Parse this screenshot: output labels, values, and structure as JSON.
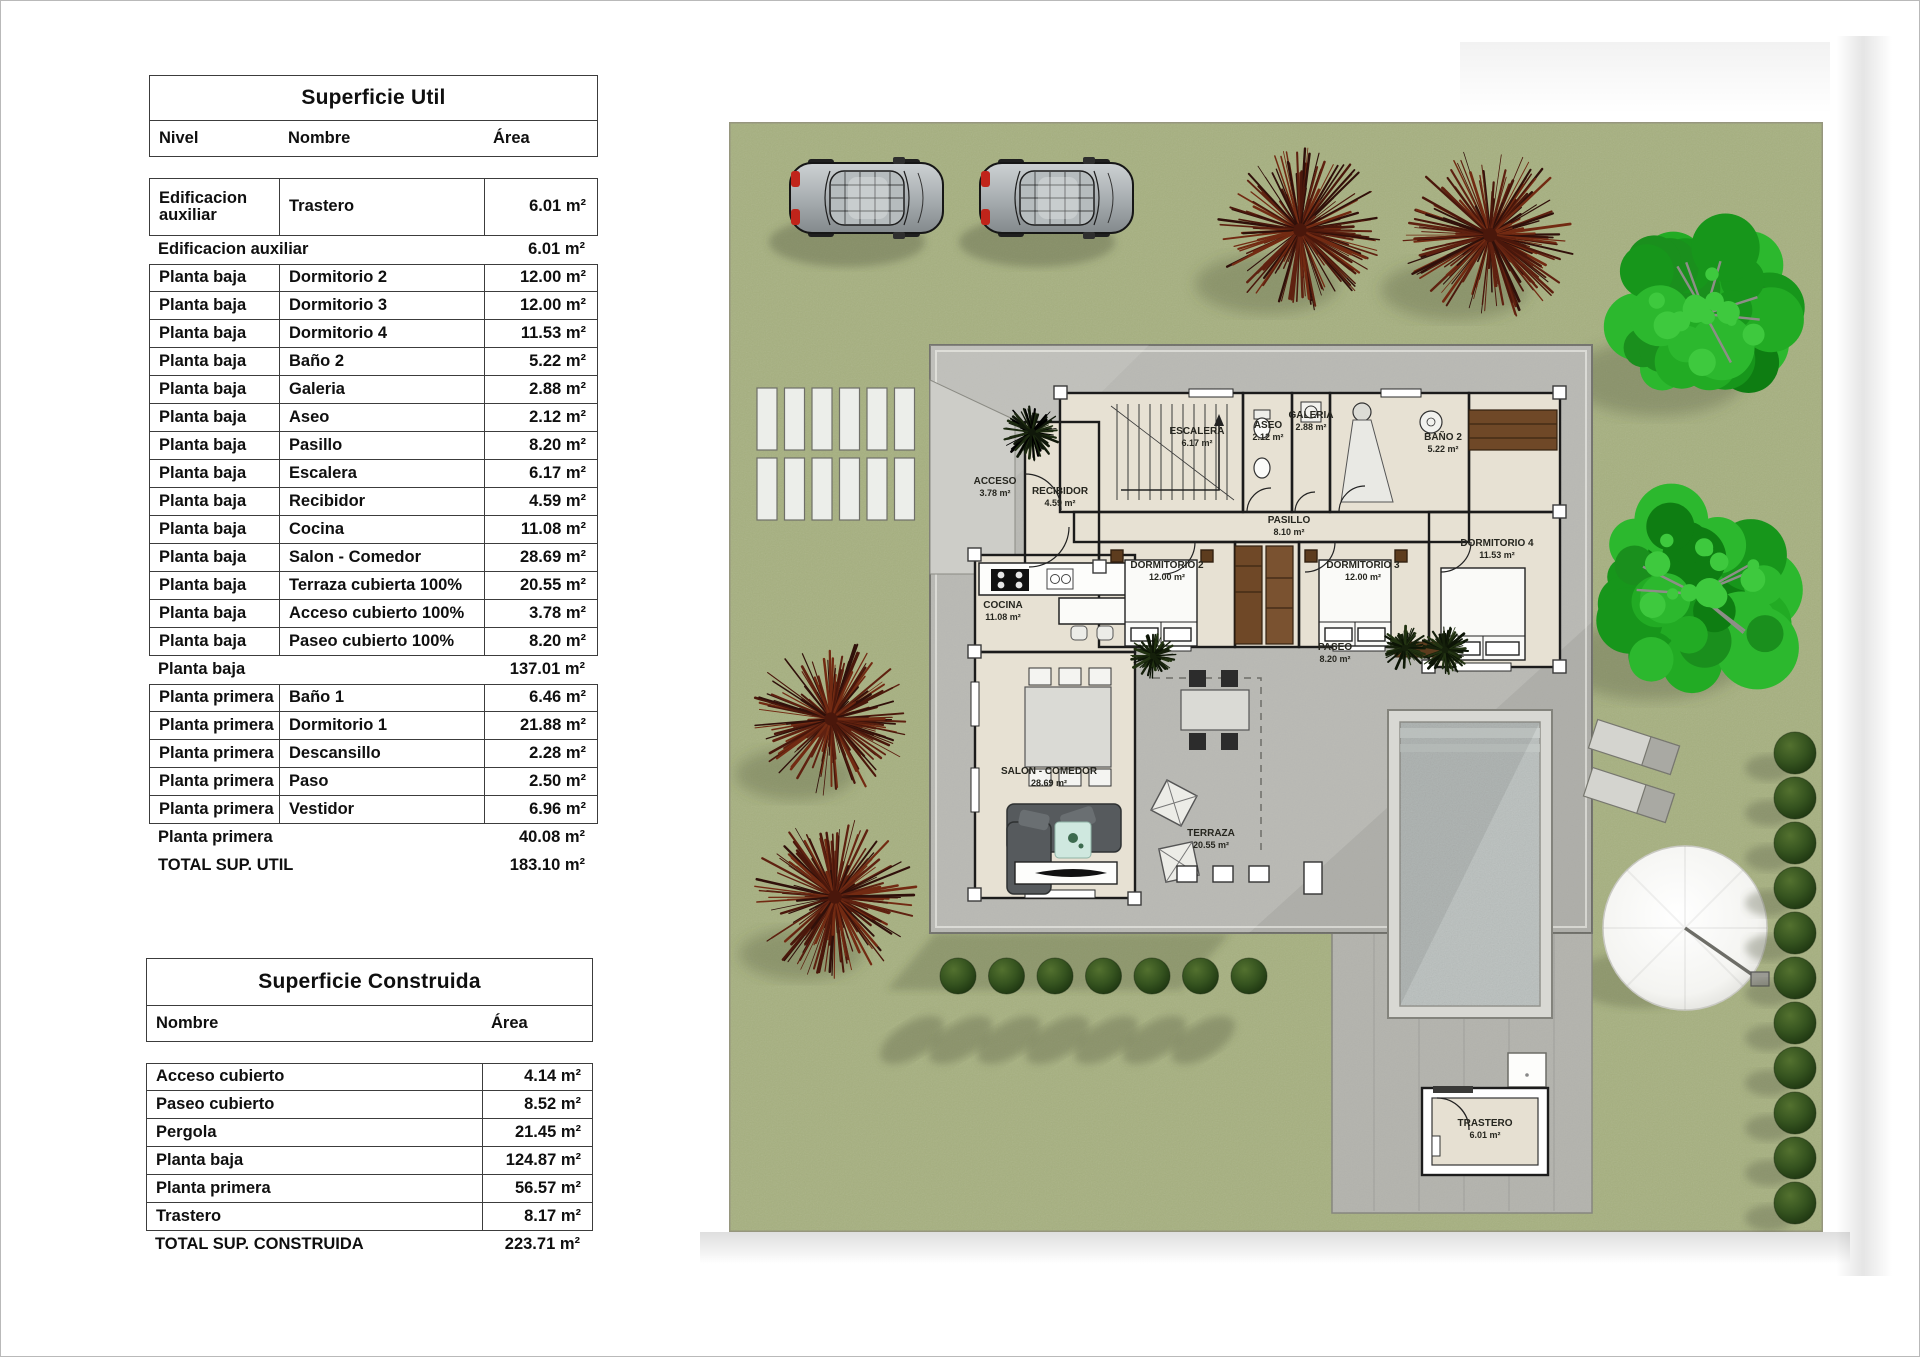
{
  "tables": {
    "util": {
      "title": "Superficie Util",
      "headers": {
        "nivel": "Nivel",
        "nombre": "Nombre",
        "area": "Área"
      },
      "rows": [
        {
          "type": "tall",
          "nivel": "Edificacion auxiliar",
          "nombre": "Trastero",
          "area": "6.01 m²"
        },
        {
          "type": "subtotal",
          "nivel": "Edificacion auxiliar",
          "nombre": "",
          "area": "6.01 m²"
        },
        {
          "type": "datafirst",
          "nivel": "Planta baja",
          "nombre": "Dormitorio 2",
          "area": "12.00 m²"
        },
        {
          "type": "data",
          "nivel": "Planta baja",
          "nombre": "Dormitorio 3",
          "area": "12.00 m²"
        },
        {
          "type": "data",
          "nivel": "Planta baja",
          "nombre": "Dormitorio 4",
          "area": "11.53 m²"
        },
        {
          "type": "data",
          "nivel": "Planta baja",
          "nombre": "Baño 2",
          "area": "5.22 m²"
        },
        {
          "type": "data",
          "nivel": "Planta baja",
          "nombre": "Galeria",
          "area": "2.88 m²"
        },
        {
          "type": "data",
          "nivel": "Planta baja",
          "nombre": "Aseo",
          "area": "2.12 m²"
        },
        {
          "type": "data",
          "nivel": "Planta baja",
          "nombre": "Pasillo",
          "area": "8.20 m²"
        },
        {
          "type": "data",
          "nivel": "Planta baja",
          "nombre": "Escalera",
          "area": "6.17 m²"
        },
        {
          "type": "data",
          "nivel": "Planta baja",
          "nombre": "Recibidor",
          "area": "4.59 m²"
        },
        {
          "type": "data",
          "nivel": "Planta baja",
          "nombre": "Cocina",
          "area": "11.08 m²"
        },
        {
          "type": "data",
          "nivel": "Planta baja",
          "nombre": "Salon - Comedor",
          "area": "28.69 m²"
        },
        {
          "type": "data",
          "nivel": "Planta baja",
          "nombre": "Terraza cubierta 100%",
          "area": "20.55 m²"
        },
        {
          "type": "data",
          "nivel": "Planta baja",
          "nombre": "Acceso cubierto 100%",
          "area": "3.78 m²"
        },
        {
          "type": "data",
          "nivel": "Planta baja",
          "nombre": "Paseo cubierto 100%",
          "area": "8.20 m²"
        },
        {
          "type": "subtotal",
          "nivel": "Planta baja",
          "nombre": "",
          "area": "137.01 m²"
        },
        {
          "type": "datafirst",
          "nivel": "Planta primera",
          "nombre": "Baño 1",
          "area": "6.46 m²"
        },
        {
          "type": "data",
          "nivel": "Planta primera",
          "nombre": "Dormitorio 1",
          "area": "21.88 m²"
        },
        {
          "type": "data",
          "nivel": "Planta primera",
          "nombre": "Descansillo",
          "area": "2.28 m²"
        },
        {
          "type": "data",
          "nivel": "Planta primera",
          "nombre": "Paso",
          "area": "2.50 m²"
        },
        {
          "type": "data",
          "nivel": "Planta primera",
          "nombre": "Vestidor",
          "area": "6.96 m²"
        },
        {
          "type": "subtotal",
          "nivel": "Planta primera",
          "nombre": "",
          "area": "40.08 m²"
        },
        {
          "type": "total",
          "nivel": "TOTAL SUP. UTIL",
          "nombre": "",
          "area": "183.10 m²"
        }
      ]
    },
    "construida": {
      "title": "Superficie Construida",
      "headers": {
        "nombre": "Nombre",
        "area": "Área"
      },
      "rows": [
        {
          "type": "datafirst",
          "nombre": "Acceso cubierto",
          "area": "4.14 m²"
        },
        {
          "type": "data",
          "nombre": "Paseo cubierto",
          "area": "8.52 m²"
        },
        {
          "type": "data",
          "nombre": "Pergola",
          "area": "21.45 m²"
        },
        {
          "type": "data",
          "nombre": "Planta baja",
          "area": "124.87 m²"
        },
        {
          "type": "data",
          "nombre": "Planta primera",
          "area": "56.57 m²"
        },
        {
          "type": "data",
          "nombre": "Trastero",
          "area": "8.17 m²"
        },
        {
          "type": "total",
          "nombre": "TOTAL SUP. CONSTRUIDA",
          "area": "223.71 m²"
        }
      ]
    }
  },
  "plan": {
    "labels": [
      {
        "key": "acceso",
        "name": "ACCESO",
        "area": "3.78 m²",
        "x": 266,
        "y": 362
      },
      {
        "key": "recibidor",
        "name": "RECIBIDOR",
        "area": "4.59 m²",
        "x": 331,
        "y": 372
      },
      {
        "key": "escalera",
        "name": "ESCALERA",
        "area": "6.17 m²",
        "x": 468,
        "y": 312
      },
      {
        "key": "aseo",
        "name": "ASEO",
        "area": "2.12 m²",
        "x": 539,
        "y": 306
      },
      {
        "key": "galeria",
        "name": "GALERIA",
        "area": "2.88 m²",
        "x": 582,
        "y": 296
      },
      {
        "key": "bano2",
        "name": "BAÑO 2",
        "area": "5.22 m²",
        "x": 714,
        "y": 318
      },
      {
        "key": "pasillo",
        "name": "PASILLO",
        "area": "8.10 m²",
        "x": 560,
        "y": 401
      },
      {
        "key": "dorm2",
        "name": "DORMITORIO 2",
        "area": "12.00 m²",
        "x": 438,
        "y": 446
      },
      {
        "key": "dorm3",
        "name": "DORMITORIO 3",
        "area": "12.00 m²",
        "x": 634,
        "y": 446
      },
      {
        "key": "dorm4",
        "name": "DORMITORIO 4",
        "area": "11.53 m²",
        "x": 768,
        "y": 424
      },
      {
        "key": "cocina",
        "name": "COCINA",
        "area": "11.08 m²",
        "x": 274,
        "y": 486
      },
      {
        "key": "salon",
        "name": "SALON - COMEDOR",
        "area": "28.69 m²",
        "x": 320,
        "y": 652
      },
      {
        "key": "terraza",
        "name": "TERRAZA",
        "area": "20.55 m²",
        "x": 482,
        "y": 714
      },
      {
        "key": "paseo",
        "name": "PASEO",
        "area": "8.20 m²",
        "x": 606,
        "y": 528
      },
      {
        "key": "trastero",
        "name": "TRASTERO",
        "area": "6.01 m²",
        "x": 756,
        "y": 1004
      }
    ],
    "colors": {
      "grass": "#a6b07f",
      "roof": "#b9b9b4",
      "deck": "#b3b3ad",
      "floor": "#e7e1d3",
      "wall": "#1b1b1b",
      "pool": "#b9bfbd",
      "red_tree": "#5a2012",
      "green_tree": "#1fa01f",
      "hedge_bush": "#2e4b1c",
      "wardrobe": "#6f4827",
      "sofa": "#565a5d"
    },
    "site_elements": [
      "car",
      "car",
      "red-tree",
      "red-tree",
      "green-tree",
      "green-tree",
      "red-bush",
      "red-bush",
      "stepping-slabs",
      "pool",
      "parasol",
      "sun-lounger",
      "sun-lounger",
      "hedge-row",
      "hedge-column",
      "storage-shed"
    ]
  }
}
